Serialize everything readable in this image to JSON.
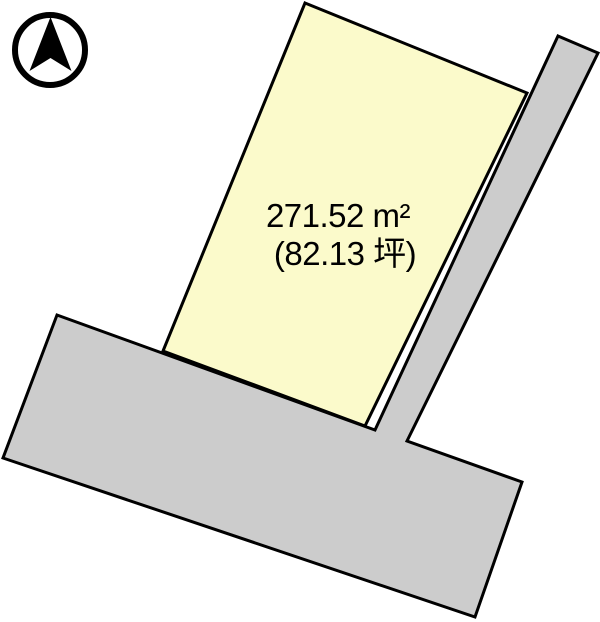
{
  "diagram": {
    "type": "land-plot-layout",
    "plot": {
      "area_sqm_label": "271.52 m²",
      "area_tsubo_label": "(82.13 坪)"
    },
    "icons": {
      "compass": "north-arrow-icon"
    }
  },
  "colors": {
    "plot_fill": "#FBFACB",
    "road_fill": "#CCCCCC",
    "outline": "#000000",
    "compass": "#000000",
    "background": "#FFFFFF"
  }
}
